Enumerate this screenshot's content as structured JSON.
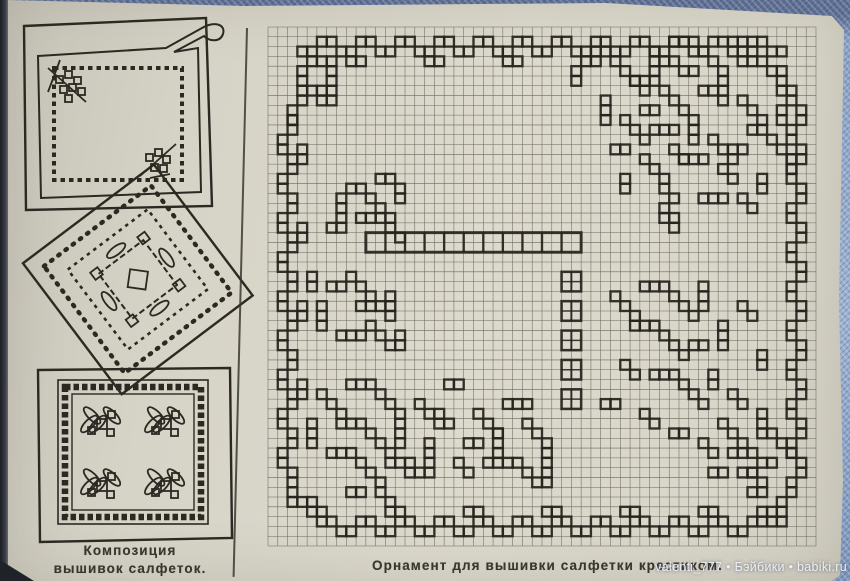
{
  "photo": {
    "colors": {
      "paper": "#d9d6ca",
      "ink": "#26241d",
      "grid_line": "#6b695c",
      "caption_ink": "#38362e",
      "fabric_blue": "#9db2d2",
      "fabric_blue_dark": "#5d6e92",
      "spine_shadow": "#23242c",
      "watermark_text": "#edeff4"
    }
  },
  "left_panel": {
    "caption": {
      "line1": "Композиция",
      "line2": "вышивок салфеток."
    },
    "caption_full": "Композиции вышивок салфеток.",
    "illustration_names": [
      "napkin-with-curled-corner-and-chain-border",
      "diamond-napkin-with-scalloped-edge-and-floral-wreath",
      "square-napkin-with-checkered-border-and-four-leaf-motifs"
    ]
  },
  "chart": {
    "caption": "Орнамент для вышивки салфетки крестиком.",
    "grid": {
      "cols": 56,
      "rows": 53
    },
    "band": {
      "col": 10,
      "row": 21,
      "width": 22,
      "height": 2,
      "divider_step": 2
    },
    "chain": {
      "col": 30,
      "row": 25,
      "width": 2,
      "block_h": 2,
      "gap": 1,
      "blocks": 5
    },
    "pattern_runs": [
      [
        3,
        2,
        1,
        0,
        2
      ],
      [
        5,
        1,
        1,
        0,
        2
      ],
      [
        7,
        2,
        1,
        0,
        2
      ],
      [
        9,
        1,
        1,
        0,
        2
      ],
      [
        11,
        2,
        1,
        0,
        2
      ],
      [
        13,
        1,
        1,
        0,
        2
      ],
      [
        15,
        2,
        1,
        0,
        2
      ],
      [
        17,
        1,
        1,
        0,
        2
      ],
      [
        19,
        2,
        1,
        0,
        2
      ],
      [
        21,
        1,
        1,
        0,
        2
      ],
      [
        23,
        2,
        1,
        0,
        2
      ],
      [
        25,
        1,
        1,
        0,
        2
      ],
      [
        27,
        2,
        1,
        0,
        2
      ],
      [
        29,
        1,
        1,
        0,
        2
      ],
      [
        31,
        2,
        1,
        0,
        2
      ],
      [
        33,
        1,
        1,
        0,
        2
      ],
      [
        35,
        2,
        1,
        0,
        2
      ],
      [
        37,
        1,
        1,
        0,
        2
      ],
      [
        39,
        2,
        1,
        0,
        2
      ],
      [
        41,
        1,
        1,
        0,
        2
      ],
      [
        43,
        2,
        1,
        0,
        2
      ],
      [
        45,
        1,
        1,
        0,
        2
      ],
      [
        47,
        2,
        1,
        0,
        2
      ],
      [
        49,
        1,
        1,
        0,
        2
      ],
      [
        51,
        2,
        1,
        0,
        2
      ],
      [
        8,
        3,
        1,
        0,
        2
      ],
      [
        16,
        3,
        1,
        0,
        2
      ],
      [
        24,
        3,
        1,
        0,
        2
      ],
      [
        32,
        3,
        1,
        0,
        2
      ],
      [
        40,
        3,
        1,
        0,
        2
      ],
      [
        48,
        3,
        1,
        0,
        2
      ],
      [
        4,
        3,
        1,
        0,
        3
      ],
      [
        3,
        4,
        0,
        1,
        4
      ],
      [
        6,
        4,
        0,
        1,
        3
      ],
      [
        4,
        6,
        1,
        0,
        2
      ],
      [
        5,
        7,
        1,
        0,
        2
      ],
      [
        2,
        8,
        0,
        1,
        2
      ],
      [
        2,
        9,
        0,
        1,
        2
      ],
      [
        1,
        11,
        0,
        1,
        2
      ],
      [
        2,
        13,
        0,
        1,
        2
      ],
      [
        1,
        15,
        0,
        1,
        2
      ],
      [
        2,
        17,
        0,
        1,
        2
      ],
      [
        1,
        19,
        0,
        1,
        2
      ],
      [
        2,
        21,
        0,
        1,
        2
      ],
      [
        1,
        23,
        0,
        1,
        2
      ],
      [
        2,
        25,
        0,
        1,
        2
      ],
      [
        1,
        27,
        0,
        1,
        2
      ],
      [
        2,
        29,
        0,
        1,
        2
      ],
      [
        1,
        31,
        0,
        1,
        2
      ],
      [
        2,
        33,
        0,
        1,
        2
      ],
      [
        1,
        35,
        0,
        1,
        2
      ],
      [
        2,
        37,
        0,
        1,
        2
      ],
      [
        1,
        39,
        0,
        1,
        2
      ],
      [
        2,
        41,
        0,
        1,
        2
      ],
      [
        1,
        43,
        0,
        1,
        2
      ],
      [
        2,
        45,
        0,
        1,
        2
      ],
      [
        3,
        12,
        0,
        1,
        2
      ],
      [
        3,
        20,
        0,
        1,
        2
      ],
      [
        3,
        28,
        0,
        1,
        2
      ],
      [
        3,
        36,
        0,
        1,
        2
      ],
      [
        2,
        47,
        0,
        1,
        2
      ],
      [
        3,
        48,
        1,
        0,
        2
      ],
      [
        4,
        49,
        1,
        0,
        2
      ],
      [
        5,
        50,
        1,
        0,
        2
      ],
      [
        7,
        51,
        1,
        0,
        2
      ],
      [
        9,
        50,
        1,
        0,
        2
      ],
      [
        11,
        51,
        1,
        0,
        2
      ],
      [
        13,
        50,
        1,
        0,
        2
      ],
      [
        15,
        51,
        1,
        0,
        2
      ],
      [
        17,
        50,
        1,
        0,
        2
      ],
      [
        19,
        51,
        1,
        0,
        2
      ],
      [
        21,
        50,
        1,
        0,
        2
      ],
      [
        23,
        51,
        1,
        0,
        2
      ],
      [
        25,
        50,
        1,
        0,
        2
      ],
      [
        27,
        51,
        1,
        0,
        2
      ],
      [
        29,
        50,
        1,
        0,
        2
      ],
      [
        31,
        51,
        1,
        0,
        2
      ],
      [
        33,
        50,
        1,
        0,
        2
      ],
      [
        35,
        51,
        1,
        0,
        2
      ],
      [
        37,
        50,
        1,
        0,
        2
      ],
      [
        39,
        51,
        1,
        0,
        2
      ],
      [
        41,
        50,
        1,
        0,
        2
      ],
      [
        43,
        51,
        1,
        0,
        2
      ],
      [
        45,
        50,
        1,
        0,
        2
      ],
      [
        47,
        51,
        1,
        0,
        2
      ],
      [
        49,
        50,
        1,
        0,
        2
      ],
      [
        12,
        49,
        1,
        0,
        2
      ],
      [
        20,
        49,
        1,
        0,
        2
      ],
      [
        28,
        49,
        1,
        0,
        2
      ],
      [
        36,
        49,
        1,
        0,
        2
      ],
      [
        44,
        49,
        1,
        0,
        2
      ],
      [
        53,
        6,
        0,
        1,
        2
      ],
      [
        54,
        8,
        0,
        1,
        2
      ],
      [
        53,
        10,
        0,
        1,
        2
      ],
      [
        54,
        12,
        0,
        1,
        2
      ],
      [
        53,
        14,
        0,
        1,
        2
      ],
      [
        54,
        16,
        0,
        1,
        2
      ],
      [
        53,
        18,
        0,
        1,
        2
      ],
      [
        54,
        20,
        0,
        1,
        2
      ],
      [
        53,
        22,
        0,
        1,
        2
      ],
      [
        54,
        24,
        0,
        1,
        2
      ],
      [
        53,
        26,
        0,
        1,
        2
      ],
      [
        54,
        28,
        0,
        1,
        2
      ],
      [
        53,
        30,
        0,
        1,
        2
      ],
      [
        54,
        32,
        0,
        1,
        2
      ],
      [
        53,
        34,
        0,
        1,
        2
      ],
      [
        54,
        36,
        0,
        1,
        2
      ],
      [
        53,
        38,
        0,
        1,
        2
      ],
      [
        54,
        40,
        0,
        1,
        2
      ],
      [
        53,
        42,
        0,
        1,
        2
      ],
      [
        54,
        44,
        0,
        1,
        2
      ],
      [
        53,
        46,
        0,
        1,
        2
      ],
      [
        52,
        48,
        0,
        1,
        2
      ],
      [
        50,
        49,
        1,
        0,
        2
      ],
      [
        51,
        50,
        1,
        0,
        2
      ],
      [
        49,
        47,
        1,
        0,
        2
      ],
      [
        48,
        45,
        1,
        0,
        2
      ],
      [
        50,
        44,
        1,
        0,
        2
      ],
      [
        46,
        40,
        1,
        1,
        3
      ],
      [
        50,
        39,
        0,
        1,
        3
      ],
      [
        47,
        43,
        1,
        0,
        3
      ],
      [
        51,
        41,
        1,
        1,
        3
      ],
      [
        45,
        45,
        1,
        0,
        2
      ],
      [
        49,
        45,
        1,
        1,
        2
      ],
      [
        33,
        2,
        1,
        0,
        2
      ],
      [
        35,
        3,
        1,
        1,
        4
      ],
      [
        39,
        2,
        0,
        1,
        3
      ],
      [
        41,
        1,
        1,
        0,
        3
      ],
      [
        44,
        2,
        1,
        1,
        3
      ],
      [
        47,
        1,
        1,
        0,
        2
      ],
      [
        49,
        2,
        1,
        1,
        3
      ],
      [
        52,
        4,
        0,
        1,
        3
      ],
      [
        37,
        5,
        1,
        0,
        3
      ],
      [
        40,
        6,
        1,
        1,
        3
      ],
      [
        44,
        6,
        1,
        0,
        2
      ],
      [
        46,
        5,
        0,
        1,
        3
      ],
      [
        48,
        7,
        1,
        1,
        3
      ],
      [
        34,
        7,
        0,
        1,
        3
      ],
      [
        36,
        9,
        1,
        1,
        3
      ],
      [
        39,
        10,
        1,
        0,
        3
      ],
      [
        43,
        9,
        0,
        1,
        3
      ],
      [
        45,
        11,
        1,
        1,
        3
      ],
      [
        49,
        10,
        1,
        0,
        2
      ],
      [
        51,
        11,
        1,
        1,
        3
      ],
      [
        35,
        12,
        1,
        0,
        2
      ],
      [
        38,
        13,
        1,
        1,
        3
      ],
      [
        42,
        13,
        1,
        0,
        3
      ],
      [
        46,
        14,
        1,
        1,
        2
      ],
      [
        50,
        15,
        0,
        1,
        2
      ],
      [
        40,
        16,
        1,
        1,
        2
      ],
      [
        44,
        17,
        1,
        0,
        3
      ],
      [
        36,
        15,
        0,
        1,
        2
      ],
      [
        48,
        17,
        1,
        1,
        2
      ],
      [
        52,
        8,
        0,
        1,
        2
      ],
      [
        31,
        4,
        0,
        1,
        2
      ],
      [
        42,
        4,
        1,
        0,
        2
      ],
      [
        38,
        8,
        1,
        0,
        2
      ],
      [
        47,
        12,
        1,
        0,
        2
      ],
      [
        41,
        12,
        1,
        1,
        2
      ],
      [
        53,
        13,
        0,
        1,
        2
      ],
      [
        40,
        18,
        0,
        1,
        2
      ],
      [
        41,
        19,
        0,
        1,
        2
      ],
      [
        8,
        16,
        1,
        0,
        2
      ],
      [
        7,
        17,
        0,
        1,
        3
      ],
      [
        10,
        17,
        1,
        1,
        3
      ],
      [
        13,
        16,
        0,
        1,
        2
      ],
      [
        9,
        19,
        1,
        0,
        3
      ],
      [
        12,
        20,
        1,
        1,
        2
      ],
      [
        6,
        20,
        1,
        0,
        2
      ],
      [
        11,
        15,
        1,
        0,
        2
      ],
      [
        6,
        26,
        1,
        0,
        2
      ],
      [
        8,
        25,
        1,
        1,
        3
      ],
      [
        5,
        28,
        0,
        1,
        3
      ],
      [
        9,
        28,
        1,
        0,
        3
      ],
      [
        12,
        27,
        0,
        1,
        3
      ],
      [
        7,
        31,
        1,
        0,
        3
      ],
      [
        10,
        30,
        1,
        1,
        3
      ],
      [
        13,
        31,
        0,
        1,
        2
      ],
      [
        4,
        25,
        0,
        1,
        2
      ],
      [
        5,
        37,
        1,
        1,
        3
      ],
      [
        8,
        36,
        1,
        0,
        3
      ],
      [
        11,
        37,
        1,
        1,
        3
      ],
      [
        4,
        40,
        0,
        1,
        3
      ],
      [
        7,
        40,
        1,
        0,
        3
      ],
      [
        10,
        41,
        1,
        1,
        3
      ],
      [
        13,
        40,
        0,
        1,
        3
      ],
      [
        6,
        43,
        1,
        0,
        3
      ],
      [
        9,
        44,
        1,
        1,
        3
      ],
      [
        12,
        44,
        1,
        0,
        3
      ],
      [
        15,
        38,
        1,
        1,
        3
      ],
      [
        16,
        42,
        0,
        1,
        3
      ],
      [
        14,
        45,
        1,
        0,
        3
      ],
      [
        18,
        36,
        1,
        0,
        2
      ],
      [
        17,
        39,
        1,
        1,
        2
      ],
      [
        19,
        44,
        1,
        1,
        2
      ],
      [
        8,
        47,
        1,
        0,
        2
      ],
      [
        11,
        47,
        1,
        1,
        2
      ],
      [
        21,
        39,
        1,
        1,
        3
      ],
      [
        24,
        38,
        1,
        0,
        3
      ],
      [
        23,
        41,
        0,
        1,
        3
      ],
      [
        26,
        40,
        1,
        1,
        3
      ],
      [
        22,
        44,
        1,
        0,
        3
      ],
      [
        25,
        44,
        1,
        1,
        2
      ],
      [
        28,
        43,
        0,
        1,
        3
      ],
      [
        27,
        46,
        1,
        0,
        2
      ],
      [
        20,
        42,
        1,
        0,
        2
      ],
      [
        35,
        27,
        1,
        1,
        3
      ],
      [
        38,
        26,
        1,
        0,
        3
      ],
      [
        41,
        27,
        1,
        1,
        3
      ],
      [
        44,
        26,
        0,
        1,
        3
      ],
      [
        37,
        30,
        1,
        0,
        3
      ],
      [
        40,
        31,
        1,
        1,
        3
      ],
      [
        43,
        32,
        1,
        0,
        2
      ],
      [
        46,
        30,
        0,
        1,
        3
      ],
      [
        48,
        28,
        1,
        1,
        2
      ],
      [
        36,
        34,
        1,
        1,
        2
      ],
      [
        39,
        35,
        1,
        0,
        3
      ],
      [
        42,
        36,
        1,
        1,
        3
      ],
      [
        45,
        35,
        0,
        1,
        2
      ],
      [
        47,
        37,
        1,
        1,
        2
      ],
      [
        50,
        33,
        0,
        1,
        2
      ],
      [
        34,
        38,
        1,
        0,
        2
      ],
      [
        38,
        39,
        1,
        1,
        2
      ],
      [
        41,
        41,
        1,
        0,
        2
      ],
      [
        44,
        42,
        1,
        1,
        2
      ]
    ]
  },
  "watermark": {
    "text": "valenti_777 • Бэйбики • babiki.ru"
  }
}
